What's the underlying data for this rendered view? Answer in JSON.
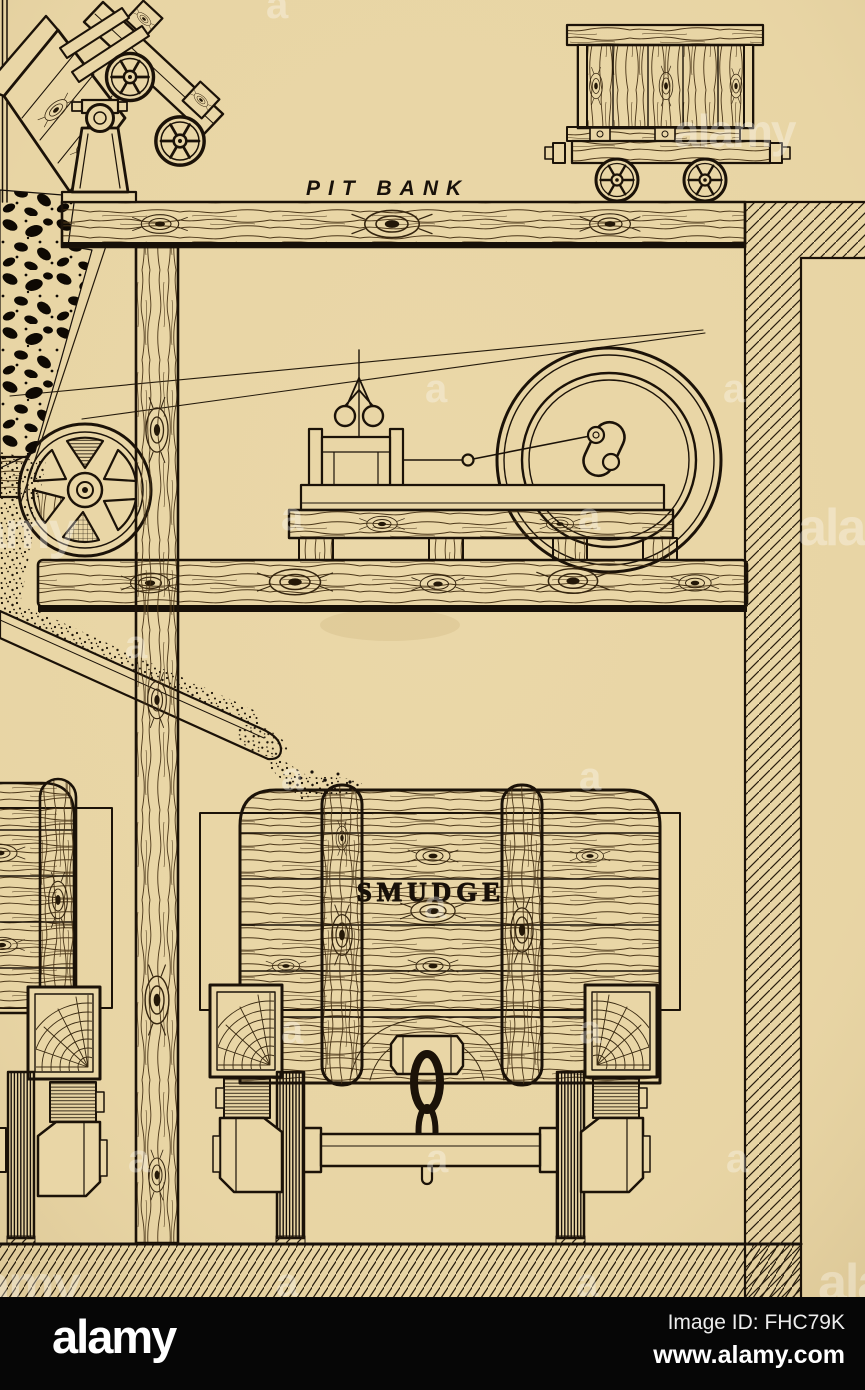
{
  "illustration": {
    "labels": {
      "pit_bank": "PIT BANK",
      "smudge": "SMUDGE"
    },
    "colors": {
      "paper": "#e9d6a6",
      "ink": "#1b1208",
      "footer_bar": "#060606",
      "watermark": "#ffffff"
    },
    "scene": {
      "description_items": [
        "tipper-cart",
        "mine-wagon",
        "winding-engine",
        "flywheel",
        "pulley-wheel",
        "coal-heap",
        "smudge-chute",
        "smudge-wagon",
        "left-wagon",
        "shaft-wall",
        "ground"
      ]
    }
  },
  "watermark": {
    "letter": "a",
    "brand": "alamy"
  },
  "footer": {
    "brand": "alamy",
    "image_id": "Image ID: FHC79K",
    "url": "www.alamy.com"
  }
}
